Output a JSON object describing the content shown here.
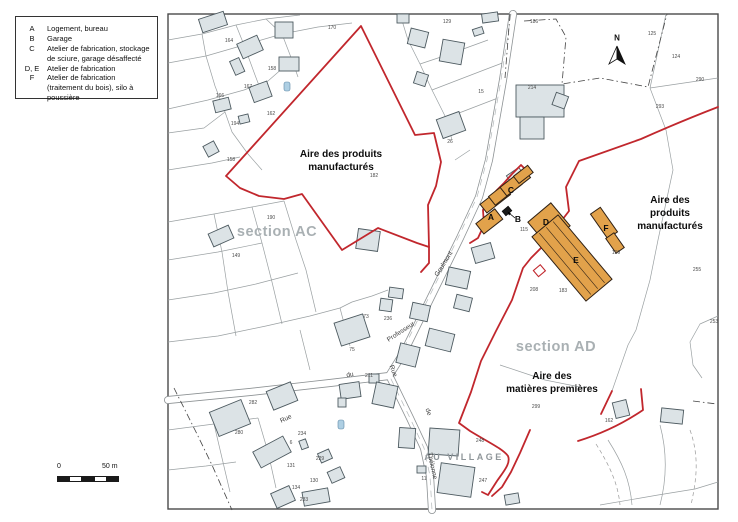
{
  "legend": {
    "items": [
      {
        "key": "A",
        "text": "Logement, bureau"
      },
      {
        "key": "B",
        "text": "Garage"
      },
      {
        "key": "C",
        "text": "Atelier de fabrication, stockage de sciure, garage désaffecté"
      },
      {
        "key": "D, E",
        "text": "Atelier de fabrication"
      },
      {
        "key": "F",
        "text": "Atelier de fabrication (traitement du bois), silo à poussière"
      }
    ]
  },
  "map": {
    "north_label": "N",
    "scalebar": {
      "start": "0",
      "end": "50 m"
    },
    "zones": [
      {
        "text": "Aire des produits\nmanufacturés",
        "x": 341,
        "y": 148
      },
      {
        "text": "Aire des produits\nmanufacturés",
        "x": 670,
        "y": 194
      },
      {
        "text": "Aire des\nmatières premières",
        "x": 552,
        "y": 370
      }
    ],
    "sections": [
      {
        "text": "section AC",
        "x": 277,
        "y": 232
      },
      {
        "text": "section AD",
        "x": 556,
        "y": 347
      }
    ],
    "village": {
      "text": "AU VILLAGE",
      "x": 464,
      "y": 457
    },
    "building_letters": [
      {
        "t": "A",
        "x": 491,
        "y": 217
      },
      {
        "t": "B",
        "x": 518,
        "y": 219
      },
      {
        "t": "C",
        "x": 511,
        "y": 190
      },
      {
        "t": "D",
        "x": 546,
        "y": 222
      },
      {
        "t": "E",
        "x": 576,
        "y": 260
      },
      {
        "t": "F",
        "x": 606,
        "y": 228
      }
    ],
    "streets": [
      {
        "t": "Goulmont",
        "x": 444,
        "y": 264,
        "r": -58
      },
      {
        "t": "Professeur",
        "x": 401,
        "y": 332,
        "r": -33
      },
      {
        "t": "du",
        "x": 350,
        "y": 375,
        "r": -10
      },
      {
        "t": "Rue",
        "x": 393,
        "y": 371,
        "r": 70
      },
      {
        "t": "de",
        "x": 428,
        "y": 412,
        "r": 72
      },
      {
        "t": "Thélonne",
        "x": 432,
        "y": 466,
        "r": 78
      },
      {
        "t": "Rue",
        "x": 286,
        "y": 419,
        "r": -25
      }
    ],
    "parcel_numbers": [
      {
        "t": "170",
        "x": 332,
        "y": 28
      },
      {
        "t": "129",
        "x": 447,
        "y": 22
      },
      {
        "t": "186",
        "x": 534,
        "y": 22
      },
      {
        "t": "164",
        "x": 229,
        "y": 41
      },
      {
        "t": "125",
        "x": 652,
        "y": 34
      },
      {
        "t": "158",
        "x": 272,
        "y": 69
      },
      {
        "t": "124",
        "x": 676,
        "y": 57
      },
      {
        "t": "167",
        "x": 248,
        "y": 87
      },
      {
        "t": "166",
        "x": 220,
        "y": 96
      },
      {
        "t": "15",
        "x": 481,
        "y": 92
      },
      {
        "t": "214",
        "x": 532,
        "y": 88
      },
      {
        "t": "290",
        "x": 700,
        "y": 80
      },
      {
        "t": "162",
        "x": 271,
        "y": 114
      },
      {
        "t": "194",
        "x": 235,
        "y": 124
      },
      {
        "t": "293",
        "x": 660,
        "y": 107
      },
      {
        "t": "26",
        "x": 450,
        "y": 142
      },
      {
        "t": "158",
        "x": 231,
        "y": 160
      },
      {
        "t": "182",
        "x": 374,
        "y": 176
      },
      {
        "t": "190",
        "x": 271,
        "y": 218
      },
      {
        "t": "115",
        "x": 524,
        "y": 230
      },
      {
        "t": "255",
        "x": 697,
        "y": 270
      },
      {
        "t": "199",
        "x": 616,
        "y": 253
      },
      {
        "t": "149",
        "x": 236,
        "y": 256
      },
      {
        "t": "208",
        "x": 534,
        "y": 290
      },
      {
        "t": "183",
        "x": 563,
        "y": 291
      },
      {
        "t": "73",
        "x": 366,
        "y": 317
      },
      {
        "t": "236",
        "x": 388,
        "y": 319
      },
      {
        "t": "211",
        "x": 369,
        "y": 376
      },
      {
        "t": "299",
        "x": 536,
        "y": 407
      },
      {
        "t": "248",
        "x": 480,
        "y": 441
      },
      {
        "t": "247",
        "x": 483,
        "y": 481
      },
      {
        "t": "11",
        "x": 424,
        "y": 479
      },
      {
        "t": "162",
        "x": 609,
        "y": 421
      },
      {
        "t": "282",
        "x": 253,
        "y": 403
      },
      {
        "t": "280",
        "x": 239,
        "y": 433
      },
      {
        "t": "234",
        "x": 302,
        "y": 434
      },
      {
        "t": "229",
        "x": 320,
        "y": 459
      },
      {
        "t": "131",
        "x": 291,
        "y": 466
      },
      {
        "t": "134",
        "x": 296,
        "y": 488
      },
      {
        "t": "130",
        "x": 314,
        "y": 481
      },
      {
        "t": "233",
        "x": 304,
        "y": 500
      },
      {
        "t": "253",
        "x": 714,
        "y": 322
      },
      {
        "t": "75",
        "x": 352,
        "y": 350
      },
      {
        "t": "6",
        "x": 291,
        "y": 443
      }
    ]
  },
  "colors": {
    "boundary_red": "#c1272d",
    "building_orange": "#e2a24b",
    "building_orange_stroke": "#2e2014",
    "building_gray": "#dce3e6",
    "building_gray_stroke": "#4d5a60",
    "water_blue": "#aecfe3",
    "parcel_line": "#9aa0a2"
  }
}
